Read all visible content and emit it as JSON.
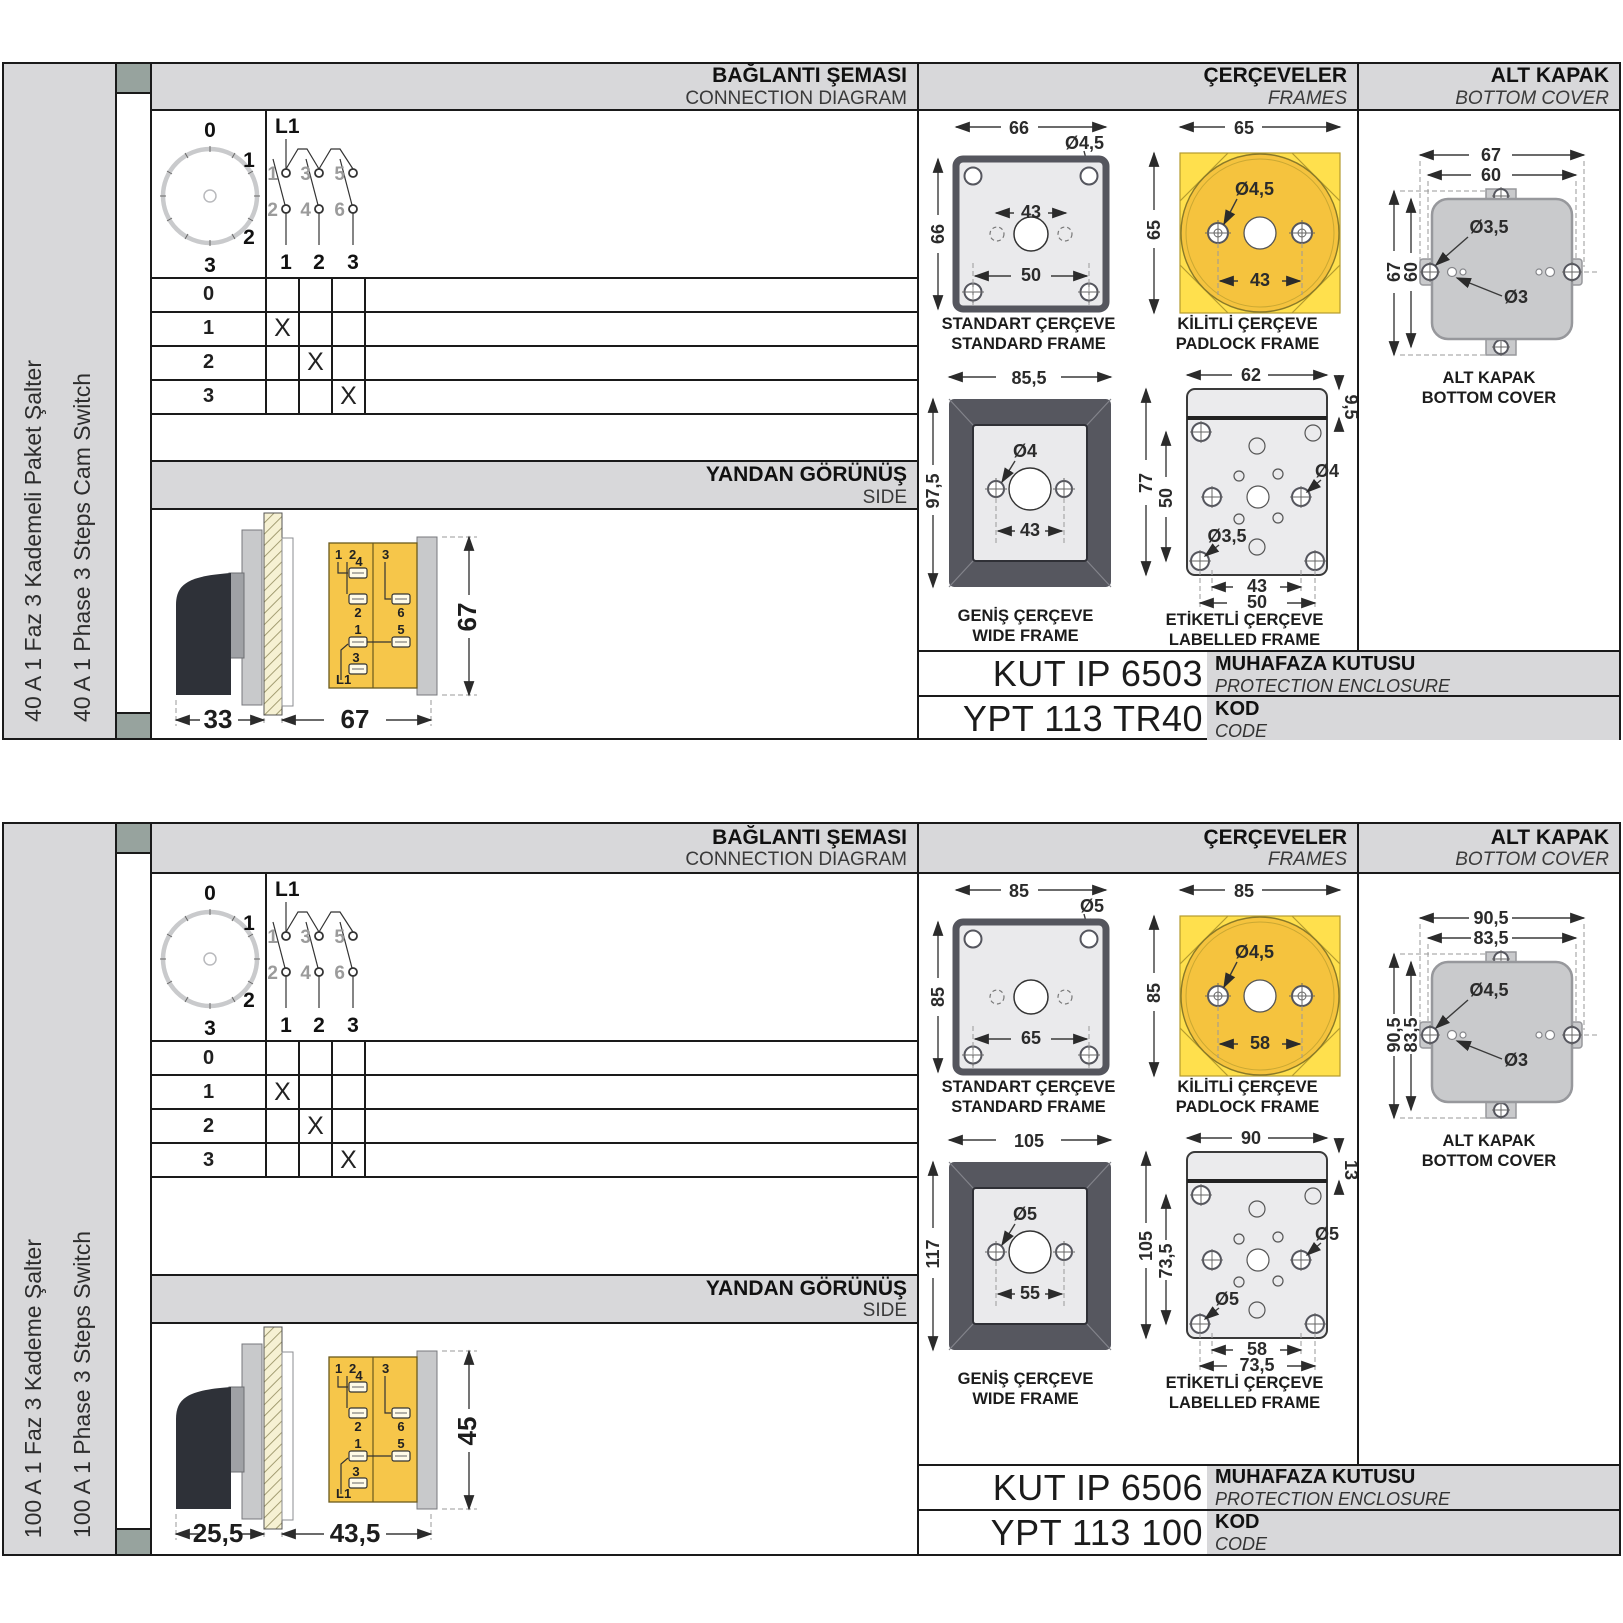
{
  "colors": {
    "body_yellow": "#f6c64a",
    "padlock_yellow": "#ffe04d",
    "padlock_circle": "#f5c33e",
    "frame_dark": "#56575f",
    "frame_light": "#eaeaec",
    "header_gray": "#d8d8da",
    "binder_sage": "#97a39e",
    "cover_gray": "#c9cacc"
  },
  "sections": [
    {
      "sidebar": {
        "label_tr": "40 A 1 Faz 3 Kademeli Paket Şalter",
        "label_en": "40 A 1 Phase 3 Steps Cam Switch"
      },
      "headers": {
        "connection_tr": "BAĞLANTI ŞEMASI",
        "connection_en": "CONNECTION DIAGRAM",
        "frames_tr": "ÇERÇEVELER",
        "frames_en": "FRAMES",
        "cover_tr": "ALT KAPAK",
        "cover_en": "BOTTOM COVER",
        "side_tr": "YANDAN GÖRÜNÜŞ",
        "side_en": "SIDE"
      },
      "dial": {
        "pos0": "0",
        "pos1": "1",
        "pos2": "2",
        "pos3": "3"
      },
      "schematic": {
        "phase": "L1",
        "t1": "1",
        "t3": "3",
        "t5": "5",
        "t2": "2",
        "t4": "4",
        "t6": "6",
        "out1": "1",
        "out2": "2",
        "out3": "3"
      },
      "truth_table": {
        "rows": [
          {
            "pos": "0",
            "c1": "",
            "c2": "",
            "c3": ""
          },
          {
            "pos": "1",
            "c1": "X",
            "c2": "",
            "c3": ""
          },
          {
            "pos": "2",
            "c1": "",
            "c2": "X",
            "c3": ""
          },
          {
            "pos": "3",
            "c1": "",
            "c2": "",
            "c3": "X"
          }
        ]
      },
      "side_view": {
        "dim_handle": "33",
        "dim_body": "67",
        "dim_height": "67",
        "labels": {
          "top1": "1",
          "top2": "2",
          "t4": "4",
          "t2": "2",
          "t1": "1",
          "t3": "3",
          "phase": "L1",
          "rtop": "3",
          "t6": "6",
          "t5": "5"
        }
      },
      "frames": {
        "standard": {
          "cap_tr": "STANDART ÇERÇEVE",
          "cap_en": "STANDARD FRAME",
          "w": "66",
          "h": "66",
          "hole": "Ø4,5",
          "inner": "43",
          "bottom": "50"
        },
        "padlock": {
          "cap_tr": "KİLİTLİ ÇERÇEVE",
          "cap_en": "PADLOCK FRAME",
          "w": "65",
          "h": "65",
          "hole": "Ø4,5",
          "inner": "43"
        },
        "wide": {
          "cap_tr": "GENİŞ ÇERÇEVE",
          "cap_en": "WIDE FRAME",
          "w": "85,5",
          "h": "97,5",
          "hole": "Ø4",
          "inner": "43"
        },
        "labelled": {
          "cap_tr": "ETİKETLİ ÇERÇEVE",
          "cap_en": "LABELLED FRAME",
          "w": "62",
          "strip": "9,5",
          "h": "77",
          "inner_h": "50",
          "hole_side": "Ø4",
          "hole_corner": "Ø3,5",
          "inner": "43",
          "outer": "50"
        }
      },
      "cover": {
        "cap_tr": "ALT KAPAK",
        "cap_en": "BOTTOM COVER",
        "w_outer": "67",
        "w_inner": "60",
        "h_outer": "67",
        "h_inner": "60",
        "hole_tab": "Ø3,5",
        "hole_small": "Ø3"
      },
      "enclosure": {
        "code": "KUT IP 6503",
        "label_tr": "MUHAFAZA KUTUSU",
        "label_en": "PROTECTION ENCLOSURE"
      },
      "product": {
        "code": "YPT 113 TR40",
        "label_tr": "KOD",
        "label_en": "CODE"
      }
    },
    {
      "sidebar": {
        "label_tr": "100 A 1 Faz 3 Kademe Şalter",
        "label_en": "100 A 1 Phase 3 Steps Switch"
      },
      "headers": {
        "connection_tr": "BAĞLANTI ŞEMASI",
        "connection_en": "CONNECTION DIAGRAM",
        "frames_tr": "ÇERÇEVELER",
        "frames_en": "FRAMES",
        "cover_tr": "ALT KAPAK",
        "cover_en": "BOTTOM COVER",
        "side_tr": "YANDAN GÖRÜNÜŞ",
        "side_en": "SIDE"
      },
      "dial": {
        "pos0": "0",
        "pos1": "1",
        "pos2": "2",
        "pos3": "3"
      },
      "schematic": {
        "phase": "L1",
        "t1": "1",
        "t3": "3",
        "t5": "5",
        "t2": "2",
        "t4": "4",
        "t6": "6",
        "out1": "1",
        "out2": "2",
        "out3": "3"
      },
      "truth_table": {
        "rows": [
          {
            "pos": "0",
            "c1": "",
            "c2": "",
            "c3": ""
          },
          {
            "pos": "1",
            "c1": "X",
            "c2": "",
            "c3": ""
          },
          {
            "pos": "2",
            "c1": "",
            "c2": "X",
            "c3": ""
          },
          {
            "pos": "3",
            "c1": "",
            "c2": "",
            "c3": "X"
          }
        ]
      },
      "side_view": {
        "dim_handle": "25,5",
        "dim_body": "43,5",
        "dim_height": "45",
        "labels": {
          "top1": "1",
          "top2": "2",
          "t4": "4",
          "t2": "2",
          "t1": "1",
          "t3": "3",
          "phase": "L1",
          "rtop": "3",
          "t6": "6",
          "t5": "5"
        }
      },
      "frames": {
        "standard": {
          "cap_tr": "STANDART ÇERÇEVE",
          "cap_en": "STANDARD FRAME",
          "w": "85",
          "h": "85",
          "hole": "Ø5",
          "inner": "",
          "bottom": "65"
        },
        "padlock": {
          "cap_tr": "KİLİTLİ ÇERÇEVE",
          "cap_en": "PADLOCK FRAME",
          "w": "85",
          "h": "85",
          "hole": "Ø4,5",
          "inner": "58"
        },
        "wide": {
          "cap_tr": "GENİŞ ÇERÇEVE",
          "cap_en": "WIDE FRAME",
          "w": "105",
          "h": "117",
          "hole": "Ø5",
          "inner": "55"
        },
        "labelled": {
          "cap_tr": "ETİKETLİ ÇERÇEVE",
          "cap_en": "LABELLED FRAME",
          "w": "90",
          "strip": "13",
          "h": "105",
          "inner_h": "73,5",
          "hole_side": "Ø5",
          "hole_corner": "Ø5",
          "inner": "58",
          "outer": "73,5"
        }
      },
      "cover": {
        "cap_tr": "ALT KAPAK",
        "cap_en": "BOTTOM COVER",
        "w_outer": "90,5",
        "w_inner": "83,5",
        "h_outer": "90,5",
        "h_inner": "83,5",
        "hole_tab": "Ø4,5",
        "hole_small": "Ø3"
      },
      "enclosure": {
        "code": "KUT IP 6506",
        "label_tr": "MUHAFAZA KUTUSU",
        "label_en": "PROTECTION ENCLOSURE"
      },
      "product": {
        "code": "YPT 113 100",
        "label_tr": "KOD",
        "label_en": "CODE"
      }
    }
  ]
}
